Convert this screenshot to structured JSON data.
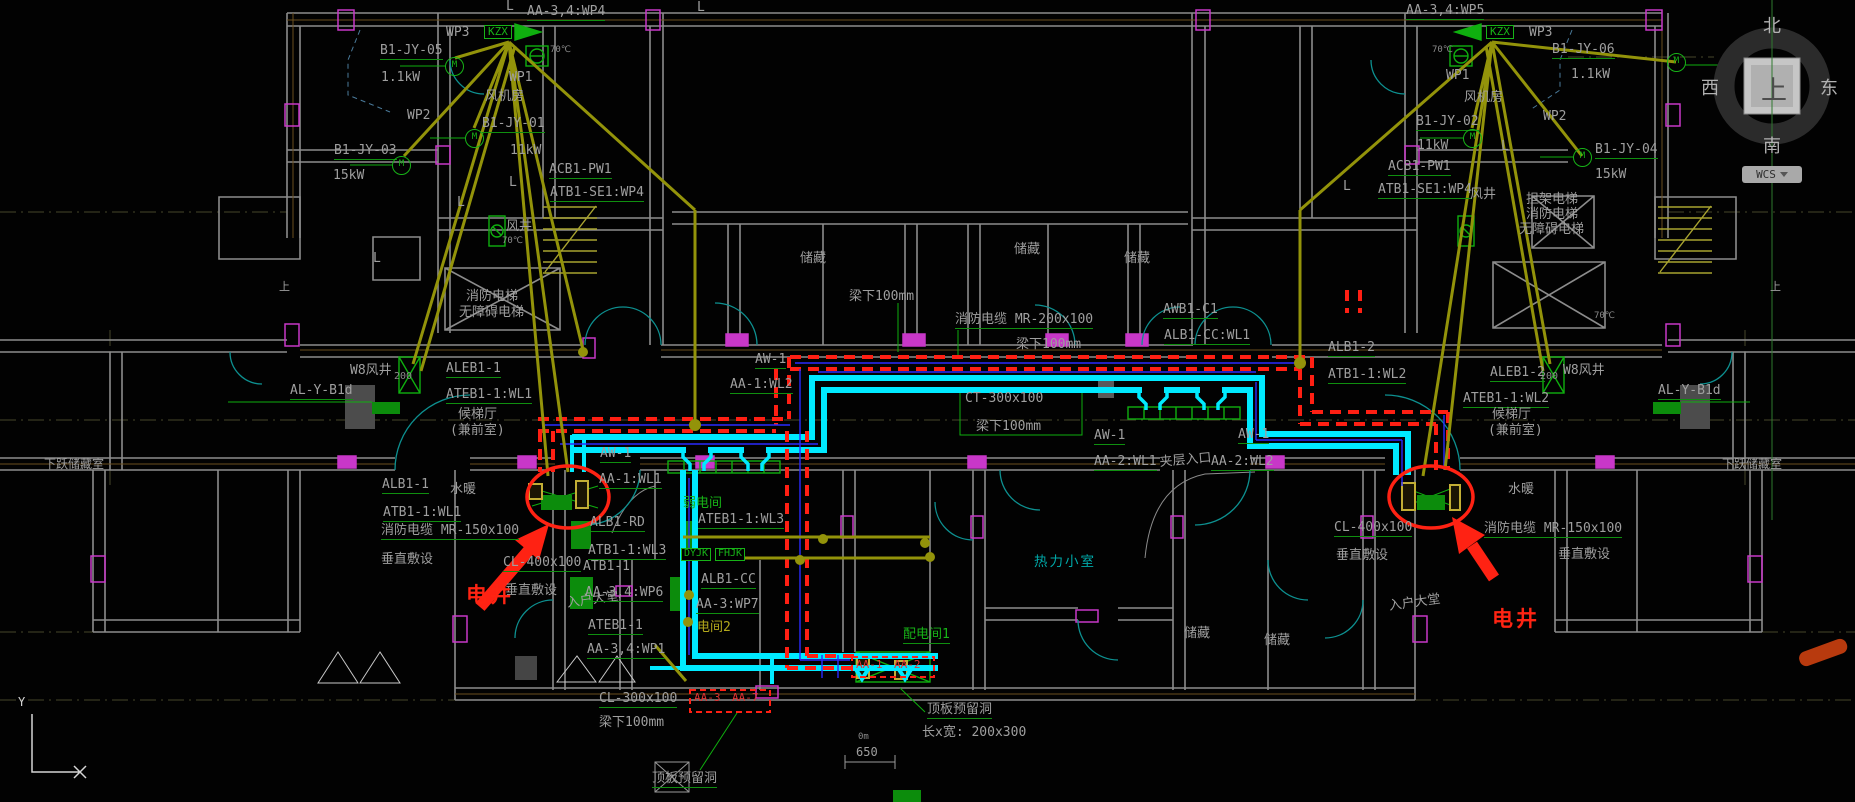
{
  "canvas": {
    "width": 1855,
    "height": 802,
    "background": "#020202"
  },
  "colors": {
    "wall": "#8c8c8c",
    "wall_inner": "#6b4f1e",
    "column": "#c837c8",
    "fire_tray_red": "#ff1f13",
    "cable_tray_cyan": "#00eaff",
    "wire_blue": "#2a2aff",
    "feeder_olive": "#93930a",
    "equipment_green": "#0faf0f",
    "annotation_red": "#ff2413",
    "door_teal": "#0d9090",
    "label_gray": "#9f9f9f"
  },
  "viewcube": {
    "north": "北",
    "south": "南",
    "east": "东",
    "west": "西",
    "top": "上"
  },
  "wcs": {
    "label": "WCS"
  },
  "ucs": {
    "y_label": "Y"
  },
  "labels": [
    {
      "t": "L",
      "x": 506,
      "y": 0
    },
    {
      "t": "L",
      "x": 697,
      "y": 1
    },
    {
      "t": "AA-3,4:WP4",
      "x": 527,
      "y": 5,
      "ld": 1
    },
    {
      "t": "WP3",
      "x": 446,
      "y": 26
    },
    {
      "t": "KZX",
      "x": 484,
      "y": 25,
      "c": "grnbox"
    },
    {
      "t": "70℃",
      "x": 550,
      "y": 46,
      "c": "tiny"
    },
    {
      "t": "B1-JY-05",
      "x": 380,
      "y": 44,
      "ld": 1
    },
    {
      "t": "1.1kW",
      "x": 381,
      "y": 71
    },
    {
      "t": "WP1",
      "x": 509,
      "y": 71
    },
    {
      "t": "风机房",
      "x": 485,
      "y": 90
    },
    {
      "t": "WP2",
      "x": 407,
      "y": 109
    },
    {
      "t": "B1-JY-01",
      "x": 482,
      "y": 117,
      "ld": 1
    },
    {
      "t": "11kW",
      "x": 510,
      "y": 144
    },
    {
      "t": "B1-JY-03",
      "x": 334,
      "y": 144,
      "ld": 1
    },
    {
      "t": "15kW",
      "x": 333,
      "y": 169
    },
    {
      "t": "ACB1-PW1",
      "x": 549,
      "y": 163,
      "ld": 1
    },
    {
      "t": "ATB1-SE1:WP4",
      "x": 550,
      "y": 186,
      "ld": 1
    },
    {
      "t": "L",
      "x": 509,
      "y": 176
    },
    {
      "t": "L",
      "x": 457,
      "y": 196
    },
    {
      "t": "L",
      "x": 373,
      "y": 252
    },
    {
      "t": "风井",
      "x": 506,
      "y": 220
    },
    {
      "t": "70℃",
      "x": 502,
      "y": 237,
      "c": "tiny"
    },
    {
      "t": "消防电梯",
      "x": 466,
      "y": 290
    },
    {
      "t": "无障碍电梯",
      "x": 459,
      "y": 306
    },
    {
      "t": "上",
      "x": 279,
      "y": 281,
      "s": 11
    },
    {
      "t": "M",
      "x": 445,
      "y": 57,
      "c": "m"
    },
    {
      "t": "M",
      "x": 465,
      "y": 129,
      "c": "m"
    },
    {
      "t": "M",
      "x": 392,
      "y": 156,
      "c": "m"
    },
    {
      "t": "ALEB1-1",
      "x": 446,
      "y": 362,
      "ld": 1
    },
    {
      "t": "ATEB1-1:WL1",
      "x": 446,
      "y": 388,
      "ld": 1
    },
    {
      "t": "候梯厅",
      "x": 458,
      "y": 408
    },
    {
      "t": "(兼前室)",
      "x": 450,
      "y": 424
    },
    {
      "t": "W8风井",
      "x": 350,
      "y": 364
    },
    {
      "t": "200",
      "x": 394,
      "y": 372,
      "c": "tiny",
      "s": 10
    },
    {
      "t": "AL-Y-B1d",
      "x": 290,
      "y": 384,
      "ld": 1
    },
    {
      "t": "下跃储藏室",
      "x": 44,
      "y": 458,
      "s": 12
    },
    {
      "t": "ALB1-1",
      "x": 382,
      "y": 478,
      "ld": 1
    },
    {
      "t": "水暖",
      "x": 450,
      "y": 483
    },
    {
      "t": "ATB1-1:WL1",
      "x": 383,
      "y": 506,
      "ld": 1
    },
    {
      "t": "消防电缆 MR-150x100",
      "x": 381,
      "y": 524,
      "ld": 1
    },
    {
      "t": "垂直敷设",
      "x": 381,
      "y": 553
    },
    {
      "t": "CL-400x100",
      "x": 503,
      "y": 556,
      "ld": 1
    },
    {
      "t": "垂直敷设",
      "x": 505,
      "y": 584
    },
    {
      "t": "电井",
      "x": 466,
      "y": 584,
      "c": "red"
    },
    {
      "t": "入户大堂",
      "x": 566,
      "y": 597,
      "r": -8
    },
    {
      "t": "AA-3,4:WP6",
      "x": 585,
      "y": 586,
      "ld": 1
    },
    {
      "t": "ATEB1-1",
      "x": 588,
      "y": 619,
      "ld": 1
    },
    {
      "t": "AA-3,4:WP1",
      "x": 587,
      "y": 643,
      "ld": 1
    },
    {
      "t": "AW-1",
      "x": 600,
      "y": 447,
      "ld": 1
    },
    {
      "t": "AA-1:WL1",
      "x": 599,
      "y": 473,
      "ld": 1
    },
    {
      "t": "AW-1",
      "x": 755,
      "y": 353,
      "ld": 1
    },
    {
      "t": "AA-1:WL2",
      "x": 730,
      "y": 378,
      "ld": 1
    },
    {
      "t": "弱电间",
      "x": 683,
      "y": 497,
      "c": "grn"
    },
    {
      "t": "ATEB1-1:WL3",
      "x": 698,
      "y": 513,
      "ld": 1
    },
    {
      "t": "ALB1-RD",
      "x": 590,
      "y": 516,
      "ld": 1
    },
    {
      "t": "ATB1-1:WL3",
      "x": 588,
      "y": 544,
      "ld": 1
    },
    {
      "t": "ATB1-1",
      "x": 583,
      "y": 560
    },
    {
      "t": "DYJK",
      "x": 681,
      "y": 548,
      "c": "grnbox2"
    },
    {
      "t": "FHJK",
      "x": 715,
      "y": 548,
      "c": "grnbox2"
    },
    {
      "t": "ALB1-CC",
      "x": 701,
      "y": 573,
      "ld": 1
    },
    {
      "t": "AA-3:WP7",
      "x": 696,
      "y": 598,
      "ld": 1
    },
    {
      "t": "电间2",
      "x": 697,
      "y": 621,
      "c": "ol"
    },
    {
      "t": "储藏",
      "x": 800,
      "y": 252
    },
    {
      "t": "储藏",
      "x": 1014,
      "y": 243
    },
    {
      "t": "储藏",
      "x": 1124,
      "y": 252
    },
    {
      "t": "梁下100mm",
      "x": 849,
      "y": 290
    },
    {
      "t": "消防电缆 MR-200x100",
      "x": 955,
      "y": 313,
      "ld": 1
    },
    {
      "t": "梁下100mm",
      "x": 1016,
      "y": 338
    },
    {
      "t": "AWB1-C1",
      "x": 1163,
      "y": 303,
      "ld": 1
    },
    {
      "t": "ALB1-CC:WL1",
      "x": 1164,
      "y": 329,
      "ld": 1
    },
    {
      "t": "CT-300x100",
      "x": 965,
      "y": 392
    },
    {
      "t": "梁下100mm",
      "x": 976,
      "y": 420
    },
    {
      "t": "AW-1",
      "x": 1094,
      "y": 429,
      "ld": 1
    },
    {
      "t": "AA-2:WL1",
      "x": 1094,
      "y": 455,
      "ld": 1
    },
    {
      "t": "夹层入口",
      "x": 1159,
      "y": 456,
      "r": -5
    },
    {
      "t": "AW-1",
      "x": 1238,
      "y": 428,
      "ld": 1
    },
    {
      "t": "AA-2:WL2",
      "x": 1211,
      "y": 455,
      "ld": 1
    },
    {
      "t": "ALB1-2",
      "x": 1328,
      "y": 341,
      "ld": 1
    },
    {
      "t": "ATB1-1:WL2",
      "x": 1328,
      "y": 368,
      "ld": 1
    },
    {
      "t": "热力小室",
      "x": 1034,
      "y": 555,
      "c": "cy"
    },
    {
      "t": "配电间1",
      "x": 903,
      "y": 628,
      "c": "grn",
      "ld": 1
    },
    {
      "t": "AA-1",
      "x": 856,
      "y": 659,
      "c": "rs"
    },
    {
      "t": "AA-2",
      "x": 894,
      "y": 659,
      "c": "rs"
    },
    {
      "t": "AA-3",
      "x": 694,
      "y": 692,
      "c": "rs"
    },
    {
      "t": "AA-7",
      "x": 732,
      "y": 692,
      "c": "rs"
    },
    {
      "t": "CL-300x100",
      "x": 599,
      "y": 692,
      "ld": 1
    },
    {
      "t": "梁下100mm",
      "x": 599,
      "y": 716
    },
    {
      "t": "0m",
      "x": 858,
      "y": 733,
      "c": "tiny"
    },
    {
      "t": "650",
      "x": 856,
      "y": 746,
      "s": 12
    },
    {
      "t": "顶板预留洞",
      "x": 927,
      "y": 703,
      "ld": 1
    },
    {
      "t": "长x宽: 200x300",
      "x": 922,
      "y": 726
    },
    {
      "t": "顶板预留洞",
      "x": 652,
      "y": 772,
      "ld": 1
    },
    {
      "t": "储藏",
      "x": 1184,
      "y": 627
    },
    {
      "t": "储藏",
      "x": 1264,
      "y": 634
    },
    {
      "t": "入户大堂",
      "x": 1388,
      "y": 600,
      "r": -8
    },
    {
      "t": "电井",
      "x": 1492,
      "y": 608,
      "c": "red"
    },
    {
      "t": "AA-3,4:WP5",
      "x": 1406,
      "y": 4,
      "ld": 1
    },
    {
      "t": "KZX",
      "x": 1486,
      "y": 25,
      "c": "grnbox"
    },
    {
      "t": "WP3",
      "x": 1529,
      "y": 26
    },
    {
      "t": "70℃",
      "x": 1432,
      "y": 46,
      "c": "tiny"
    },
    {
      "t": "B1-JY-06",
      "x": 1552,
      "y": 43,
      "ld": 1
    },
    {
      "t": "1.1kW",
      "x": 1571,
      "y": 68
    },
    {
      "t": "WP1",
      "x": 1446,
      "y": 69
    },
    {
      "t": "风机房",
      "x": 1464,
      "y": 91
    },
    {
      "t": "WP2",
      "x": 1543,
      "y": 110
    },
    {
      "t": "B1-JY-02",
      "x": 1416,
      "y": 115,
      "ld": 1
    },
    {
      "t": "11kW",
      "x": 1417,
      "y": 139
    },
    {
      "t": "B1-JY-04",
      "x": 1595,
      "y": 143,
      "ld": 1
    },
    {
      "t": "15kW",
      "x": 1595,
      "y": 168
    },
    {
      "t": "ACB1-PW1",
      "x": 1388,
      "y": 160,
      "ld": 1
    },
    {
      "t": "ATB1-SE1:WP4",
      "x": 1378,
      "y": 183,
      "ld": 1
    },
    {
      "t": "L",
      "x": 1501,
      "y": 140
    },
    {
      "t": "L",
      "x": 1343,
      "y": 180
    },
    {
      "t": "风井",
      "x": 1470,
      "y": 188
    },
    {
      "t": "担架电梯",
      "x": 1526,
      "y": 193
    },
    {
      "t": "消防电梯",
      "x": 1526,
      "y": 208
    },
    {
      "t": "无障碍电梯",
      "x": 1519,
      "y": 223
    },
    {
      "t": "70℃",
      "x": 1594,
      "y": 312,
      "c": "tiny"
    },
    {
      "t": "上",
      "x": 1770,
      "y": 281,
      "s": 11
    },
    {
      "t": "M",
      "x": 1667,
      "y": 53,
      "c": "m"
    },
    {
      "t": "M",
      "x": 1463,
      "y": 129,
      "c": "m"
    },
    {
      "t": "M",
      "x": 1573,
      "y": 148,
      "c": "m"
    },
    {
      "t": "ALEB1-2",
      "x": 1490,
      "y": 366,
      "ld": 1
    },
    {
      "t": "ATEB1-1:WL2",
      "x": 1463,
      "y": 392,
      "ld": 1
    },
    {
      "t": "候梯厅",
      "x": 1492,
      "y": 408
    },
    {
      "t": "(兼前室)",
      "x": 1488,
      "y": 424
    },
    {
      "t": "W8风井",
      "x": 1563,
      "y": 364
    },
    {
      "t": "200",
      "x": 1540,
      "y": 372,
      "c": "tiny",
      "s": 10
    },
    {
      "t": "AL-Y-B1d",
      "x": 1658,
      "y": 384,
      "ld": 1
    },
    {
      "t": "下跃储藏室",
      "x": 1722,
      "y": 458,
      "s": 12
    },
    {
      "t": "水暖",
      "x": 1508,
      "y": 483
    },
    {
      "t": "CL-400x100",
      "x": 1334,
      "y": 521,
      "ld": 1
    },
    {
      "t": "垂直敷设",
      "x": 1336,
      "y": 549
    },
    {
      "t": "消防电缆 MR-150x100",
      "x": 1484,
      "y": 522,
      "ld": 1
    },
    {
      "t": "垂直敷设",
      "x": 1558,
      "y": 548
    },
    {
      "t": "Y",
      "x": 18,
      "y": 696,
      "c": "wht"
    }
  ]
}
